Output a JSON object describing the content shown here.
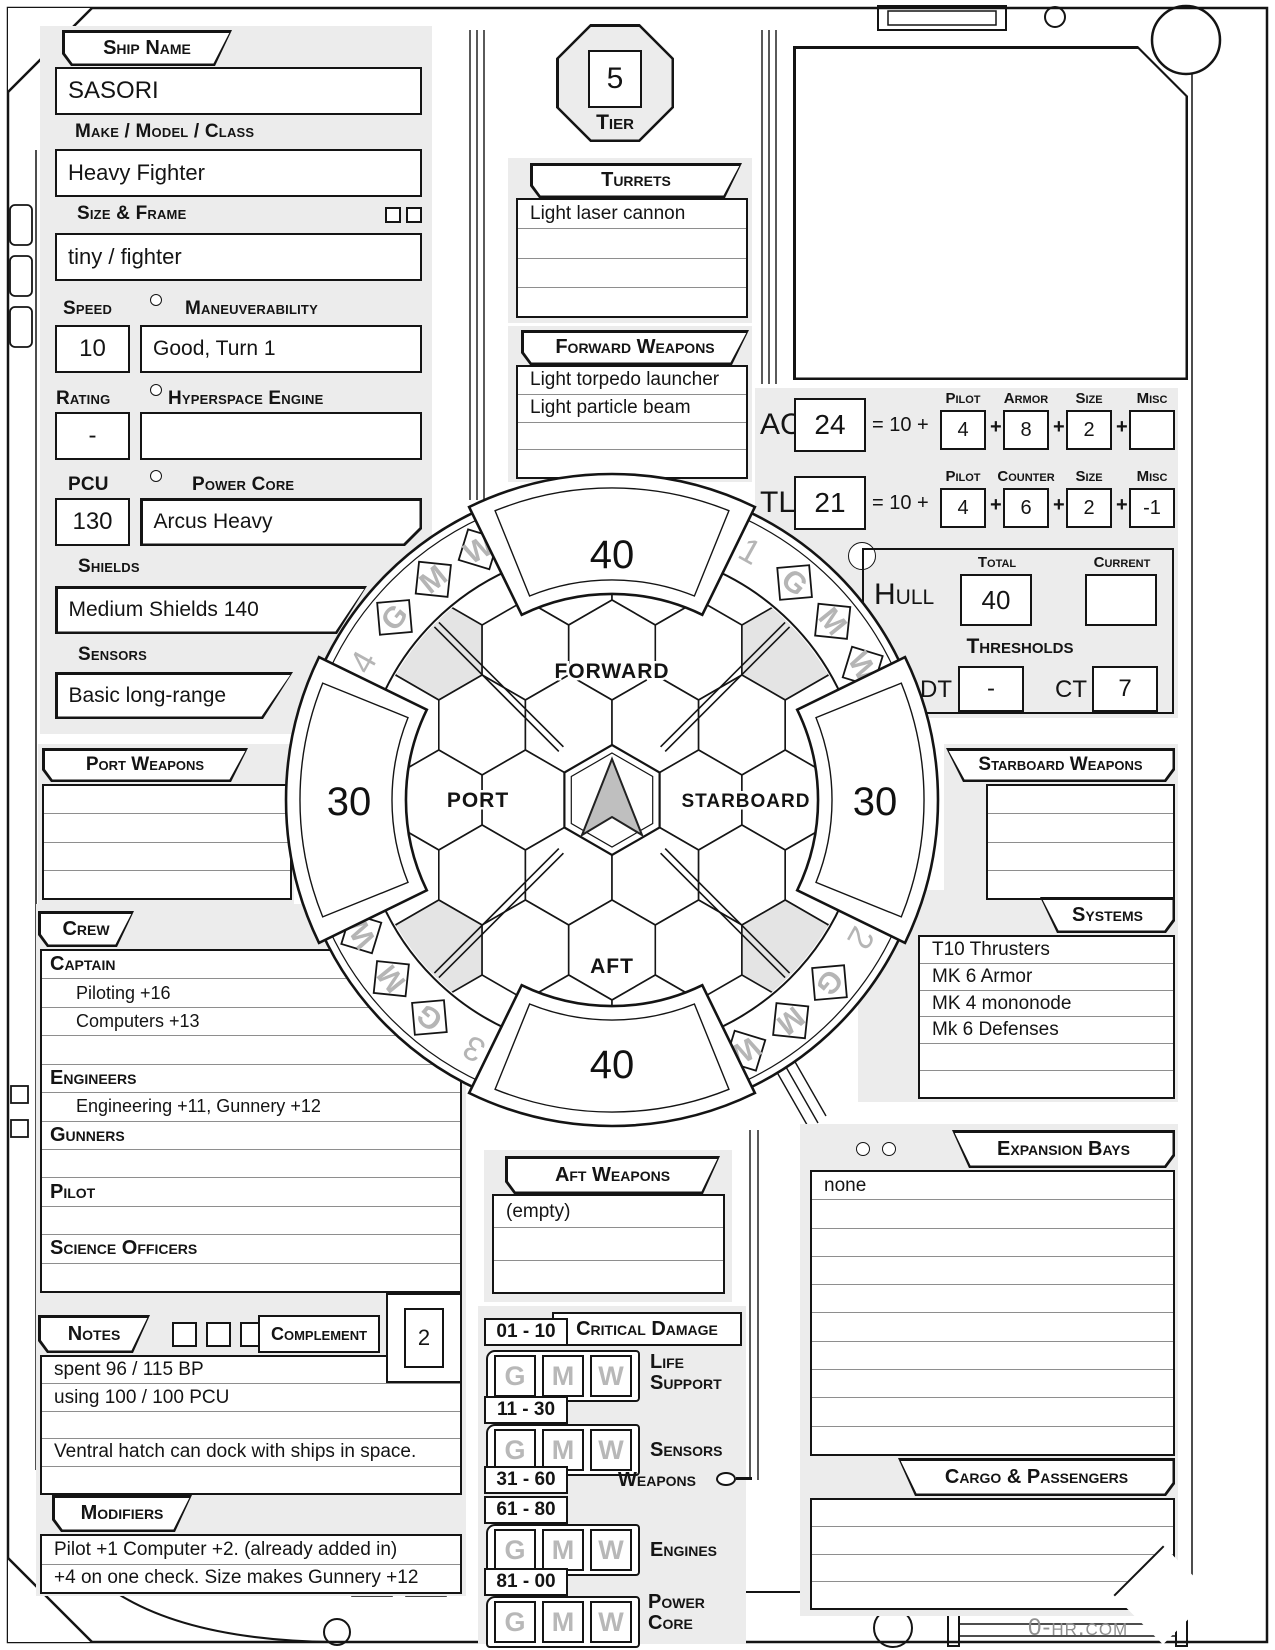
{
  "frame": {
    "watermark": "0-hr.com"
  },
  "ship": {
    "name_label": "Ship Name",
    "name": "SASORI",
    "make_label": "Make / Model / Class",
    "make": "Heavy Fighter",
    "size_label": "Size & Frame",
    "size": "tiny / fighter",
    "speed_label": "Speed",
    "speed": "10",
    "maneuverability_label": "Maneuverability",
    "maneuverability": "Good, Turn 1",
    "rating_label": "Rating",
    "rating": "-",
    "hyperspace_label": "Hyperspace Engine",
    "hyperspace": "",
    "pcu_label": "PCU",
    "pcu": "130",
    "power_core_label": "Power Core",
    "power_core": "Arcus Heavy",
    "shields_label": "Shields",
    "shields": "Medium Shields 140",
    "sensors_label": "Sensors",
    "sensors": "Basic long-range"
  },
  "tier": {
    "label": "Tier",
    "value": "5"
  },
  "turrets": {
    "label": "Turrets",
    "rows": [
      "Light laser cannon",
      "",
      "",
      ""
    ]
  },
  "forward_weapons": {
    "label": "Forward Weapons",
    "rows": [
      "Light torpedo launcher",
      "Light particle beam",
      "",
      ""
    ]
  },
  "port_weapons": {
    "label": "Port Weapons",
    "rows": [
      "",
      "",
      "",
      ""
    ]
  },
  "starboard_weapons": {
    "label": "Starboard Weapons",
    "rows": [
      "",
      "",
      "",
      ""
    ]
  },
  "aft_weapons": {
    "label": "Aft Weapons",
    "rows": [
      "(empty)",
      "",
      ""
    ]
  },
  "ac": {
    "label": "AC",
    "total": "24",
    "formula": "= 10 +",
    "plus": "+",
    "col1_label": "Pilot",
    "col1": "4",
    "col2_label": "Armor",
    "col2": "8",
    "col3_label": "Size",
    "col3": "2",
    "col4_label": "Misc",
    "col4": ""
  },
  "tl": {
    "label": "TL",
    "total": "21",
    "formula": "= 10 +",
    "plus": "+",
    "col1_label": "Pilot",
    "col1": "4",
    "col2_label": "Counter",
    "col2": "6",
    "col3_label": "Size",
    "col3": "2",
    "col4_label": "Misc",
    "col4": "-1"
  },
  "hull": {
    "label": "Hull",
    "total_label": "Total",
    "total": "40",
    "current_label": "Current",
    "current": "",
    "thresholds_label": "Thresholds",
    "dt_label": "DT",
    "dt": "-",
    "ct_label": "CT",
    "ct": "7"
  },
  "diagram": {
    "shield_forward": "40",
    "shield_aft": "40",
    "shield_port": "30",
    "shield_starboard": "30",
    "forward_label": "FORWARD",
    "aft_label": "AFT",
    "port_label": "PORT",
    "starboard_label": "STARBOARD",
    "quadrant_numbers": [
      "1",
      "2",
      "3",
      "4"
    ],
    "crit_letters": [
      "G",
      "M",
      "W"
    ]
  },
  "crew": {
    "label": "Crew",
    "rows": [
      {
        "style": "header",
        "text": "Captain"
      },
      {
        "style": "entry",
        "text": "Piloting +16"
      },
      {
        "style": "entry",
        "text": "Computers +13"
      },
      {
        "style": "entry",
        "text": ""
      },
      {
        "style": "header",
        "text": "Engineers"
      },
      {
        "style": "entry",
        "text": "Engineering +11,  Gunnery  +12"
      },
      {
        "style": "header",
        "text": "Gunners"
      },
      {
        "style": "entry",
        "text": ""
      },
      {
        "style": "header",
        "text": "Pilot"
      },
      {
        "style": "entry",
        "text": ""
      },
      {
        "style": "header",
        "text": "Science Officers"
      },
      {
        "style": "entry",
        "text": ""
      }
    ]
  },
  "systems": {
    "label": "Systems",
    "rows": [
      "T10 Thrusters",
      "MK 6 Armor",
      "MK 4 mononode",
      "Mk 6 Defenses",
      "",
      ""
    ]
  },
  "expansion_bays": {
    "label": "Expansion Bays",
    "rows": [
      "none",
      "",
      "",
      "",
      "",
      "",
      "",
      "",
      "",
      ""
    ]
  },
  "cargo": {
    "label": "Cargo & Passengers",
    "rows": [
      "",
      "",
      "",
      ""
    ]
  },
  "notes": {
    "label": "Notes",
    "complement_label": "Complement",
    "complement": "2",
    "rows": [
      "spent 96 / 115 BP",
      "using 100 / 100 PCU",
      "",
      "Ventral hatch can dock with ships in space.",
      ""
    ]
  },
  "modifiers": {
    "label": "Modifiers",
    "rows": [
      "Pilot +1  Computer +2. (already added in)",
      "+4 on one check.  Size makes Gunnery +12"
    ]
  },
  "critical": {
    "label": "Critical Damage",
    "letters": [
      "G",
      "M",
      "W"
    ],
    "rows": [
      {
        "range": "01 - 10",
        "system": "Life Support"
      },
      {
        "range": "11 - 30",
        "system": "Sensors"
      },
      {
        "range": "31 - 60",
        "system": "Weapons"
      },
      {
        "range": "61 - 80",
        "system": "Engines"
      },
      {
        "range": "81 - 00",
        "system": "Power Core"
      }
    ]
  }
}
